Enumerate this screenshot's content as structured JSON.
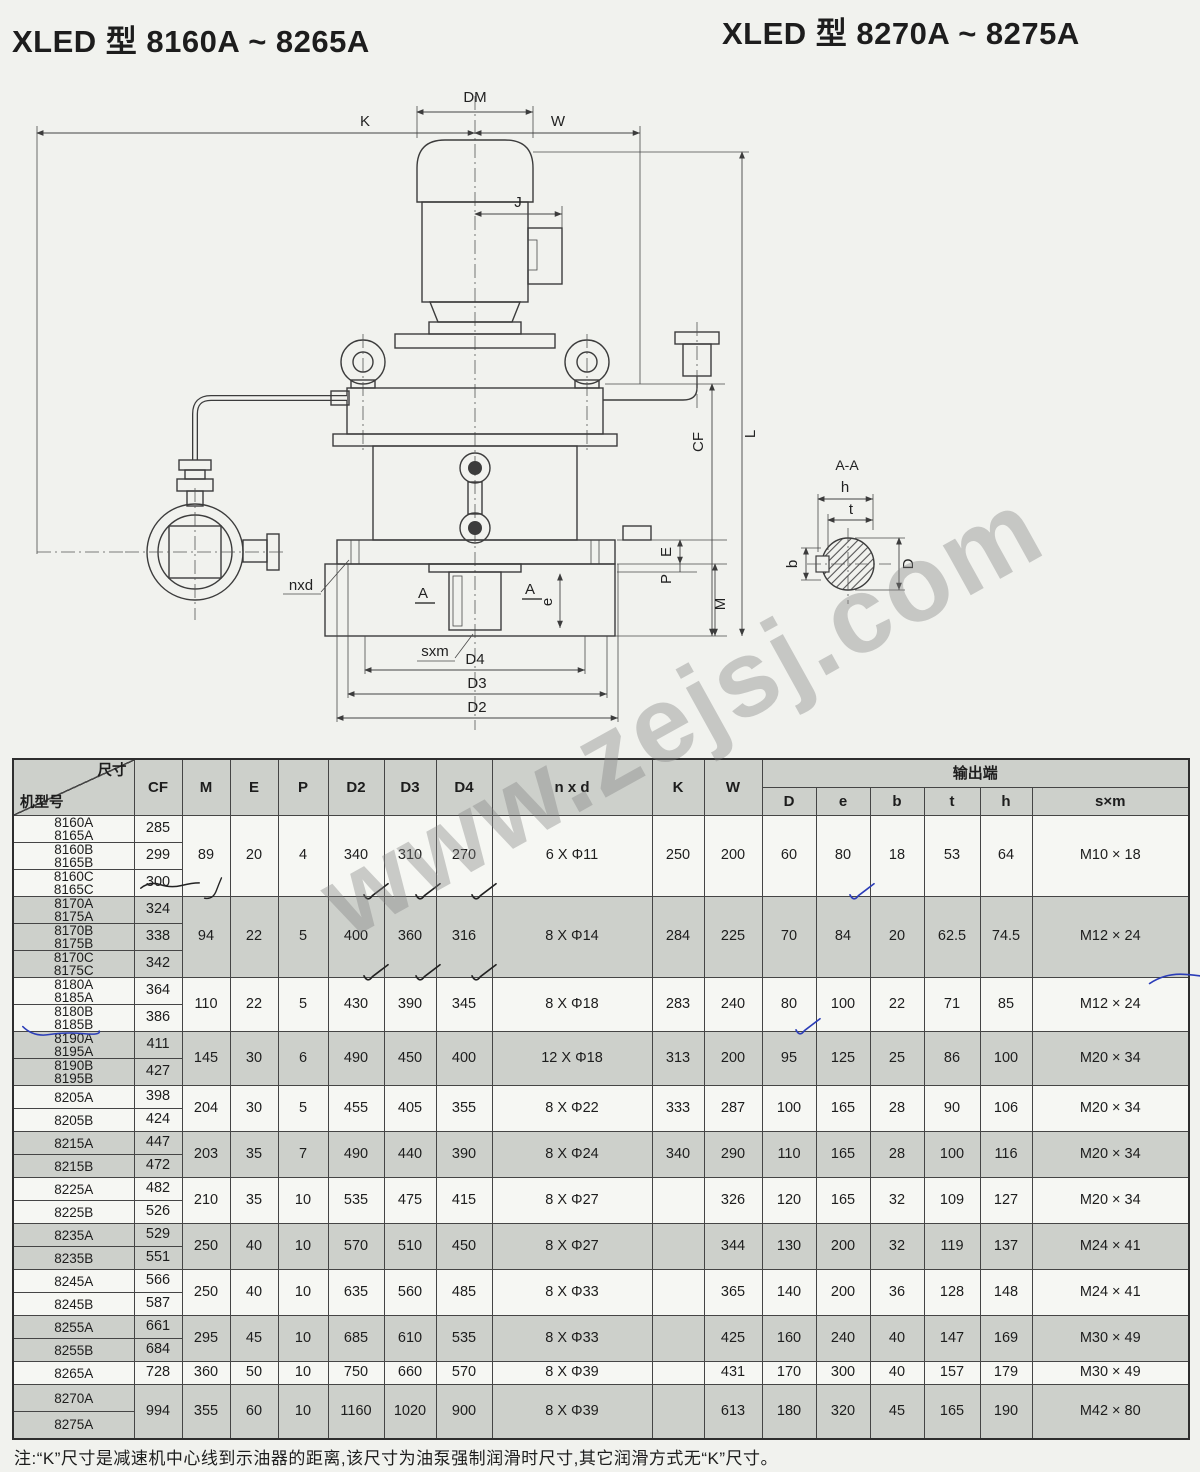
{
  "page": {
    "title_left": "XLED 型 8160A ~ 8265A",
    "title_right": "XLED 型 8270A ~ 8275A",
    "watermark": "www.zejsj.com",
    "note": "注:“K”尺寸是减速机中心线到示油器的距离,该尺寸为油泵强制润滑时尺寸,其它润滑方式无“K”尺寸。"
  },
  "drawing": {
    "labels": {
      "dm": "DM",
      "k": "K",
      "w": "W",
      "j": "J",
      "l": "L",
      "cf": "CF",
      "e": "E",
      "p": "P",
      "m": "M",
      "e2": "e",
      "nxd": "nxd",
      "sxm": "sxm",
      "a1": "A",
      "a2": "A",
      "d4": "D4",
      "d3": "D3",
      "d2": "D2",
      "sec": "A-A",
      "h": "h",
      "t": "t",
      "b": "b",
      "dd": "D"
    }
  },
  "table": {
    "corner": {
      "top": "尺寸",
      "bottom": "机型号"
    },
    "columns": [
      "CF",
      "M",
      "E",
      "P",
      "D2",
      "D3",
      "D4",
      "n x d",
      "K",
      "W"
    ],
    "output_group": {
      "label": "输出端",
      "columns": [
        "D",
        "e",
        "b",
        "t",
        "h",
        "s×m"
      ]
    },
    "groups": [
      {
        "shade": "light",
        "rows": [
          {
            "models": [
              "8160A",
              "8165A"
            ],
            "cf": "285"
          },
          {
            "models": [
              "8160B",
              "8165B"
            ],
            "cf": "299"
          },
          {
            "models": [
              "8160C",
              "8165C"
            ],
            "cf": "300"
          }
        ],
        "values": {
          "M": "89",
          "E": "20",
          "P": "4",
          "D2": "340",
          "D3": "310",
          "D4": "270",
          "nxd": "6 X Φ11",
          "K": "250",
          "W": "200",
          "D": "60",
          "e": "80",
          "b": "18",
          "t": "53",
          "h": "64",
          "sxm": "M10 × 18"
        },
        "marks": {
          "D2": "vd",
          "D3": "vd",
          "D4": "vd",
          "e": "vb",
          "M": "cd"
        },
        "row_marks": [
          {
            "row": 2,
            "col": "cf",
            "type": "st"
          }
        ]
      },
      {
        "shade": "gray",
        "rows": [
          {
            "models": [
              "8170A",
              "8175A"
            ],
            "cf": "324"
          },
          {
            "models": [
              "8170B",
              "8175B"
            ],
            "cf": "338"
          },
          {
            "models": [
              "8170C",
              "8175C"
            ],
            "cf": "342"
          }
        ],
        "values": {
          "M": "94",
          "E": "22",
          "P": "5",
          "D2": "400",
          "D3": "360",
          "D4": "316",
          "nxd": "8 X Φ14",
          "K": "284",
          "W": "225",
          "D": "70",
          "e": "84",
          "b": "20",
          "t": "62.5",
          "h": "74.5",
          "sxm": "M12 × 24"
        },
        "marks": {
          "D2": "vd",
          "D3": "vd",
          "D4": "vd",
          "sxm": "db"
        },
        "row_marks": []
      },
      {
        "shade": "light",
        "rows": [
          {
            "models": [
              "8180A",
              "8185A"
            ],
            "cf": "364"
          },
          {
            "models": [
              "8180B",
              "8185B"
            ],
            "cf": "386"
          }
        ],
        "values": {
          "M": "110",
          "E": "22",
          "P": "5",
          "D2": "430",
          "D3": "390",
          "D4": "345",
          "nxd": "8 X Φ18",
          "K": "283",
          "W": "240",
          "D": "80",
          "e": "100",
          "b": "22",
          "t": "71",
          "h": "85",
          "sxm": "M12 × 24"
        },
        "marks": {
          "D": "vb"
        },
        "row_marks": [
          {
            "row": 1,
            "col": "model",
            "type": "ub"
          }
        ]
      },
      {
        "shade": "gray",
        "rows": [
          {
            "models": [
              "8190A",
              "8195A"
            ],
            "cf": "411"
          },
          {
            "models": [
              "8190B",
              "8195B"
            ],
            "cf": "427"
          }
        ],
        "values": {
          "M": "145",
          "E": "30",
          "P": "6",
          "D2": "490",
          "D3": "450",
          "D4": "400",
          "nxd": "12 X Φ18",
          "K": "313",
          "W": "200",
          "D": "95",
          "e": "125",
          "b": "25",
          "t": "86",
          "h": "100",
          "sxm": "M20 × 34"
        },
        "marks": {},
        "row_marks": []
      },
      {
        "shade": "light",
        "rows": [
          {
            "models": [
              "8205A"
            ],
            "cf": "398"
          },
          {
            "models": [
              "8205B"
            ],
            "cf": "424"
          }
        ],
        "values": {
          "M": "204",
          "E": "30",
          "P": "5",
          "D2": "455",
          "D3": "405",
          "D4": "355",
          "nxd": "8 X Φ22",
          "K": "333",
          "W": "287",
          "D": "100",
          "e": "165",
          "b": "28",
          "t": "90",
          "h": "106",
          "sxm": "M20 × 34"
        },
        "marks": {},
        "row_marks": []
      },
      {
        "shade": "gray",
        "rows": [
          {
            "models": [
              "8215A"
            ],
            "cf": "447"
          },
          {
            "models": [
              "8215B"
            ],
            "cf": "472"
          }
        ],
        "values": {
          "M": "203",
          "E": "35",
          "P": "7",
          "D2": "490",
          "D3": "440",
          "D4": "390",
          "nxd": "8 X Φ24",
          "K": "340",
          "W": "290",
          "D": "110",
          "e": "165",
          "b": "28",
          "t": "100",
          "h": "116",
          "sxm": "M20 × 34"
        },
        "marks": {},
        "row_marks": []
      },
      {
        "shade": "light",
        "rows": [
          {
            "models": [
              "8225A"
            ],
            "cf": "482"
          },
          {
            "models": [
              "8225B"
            ],
            "cf": "526"
          }
        ],
        "values": {
          "M": "210",
          "E": "35",
          "P": "10",
          "D2": "535",
          "D3": "475",
          "D4": "415",
          "nxd": "8 X Φ27",
          "K": "",
          "W": "326",
          "D": "120",
          "e": "165",
          "b": "32",
          "t": "109",
          "h": "127",
          "sxm": "M20 × 34"
        },
        "marks": {},
        "row_marks": []
      },
      {
        "shade": "gray",
        "rows": [
          {
            "models": [
              "8235A"
            ],
            "cf": "529"
          },
          {
            "models": [
              "8235B"
            ],
            "cf": "551"
          }
        ],
        "values": {
          "M": "250",
          "E": "40",
          "P": "10",
          "D2": "570",
          "D3": "510",
          "D4": "450",
          "nxd": "8 X Φ27",
          "K": "",
          "W": "344",
          "D": "130",
          "e": "200",
          "b": "32",
          "t": "119",
          "h": "137",
          "sxm": "M24 × 41"
        },
        "marks": {},
        "row_marks": []
      },
      {
        "shade": "light",
        "rows": [
          {
            "models": [
              "8245A"
            ],
            "cf": "566"
          },
          {
            "models": [
              "8245B"
            ],
            "cf": "587"
          }
        ],
        "values": {
          "M": "250",
          "E": "40",
          "P": "10",
          "D2": "635",
          "D3": "560",
          "D4": "485",
          "nxd": "8 X Φ33",
          "K": "",
          "W": "365",
          "D": "140",
          "e": "200",
          "b": "36",
          "t": "128",
          "h": "148",
          "sxm": "M24 × 41"
        },
        "marks": {},
        "row_marks": []
      },
      {
        "shade": "gray",
        "rows": [
          {
            "models": [
              "8255A"
            ],
            "cf": "661"
          },
          {
            "models": [
              "8255B"
            ],
            "cf": "684"
          }
        ],
        "values": {
          "M": "295",
          "E": "45",
          "P": "10",
          "D2": "685",
          "D3": "610",
          "D4": "535",
          "nxd": "8 X Φ33",
          "K": "",
          "W": "425",
          "D": "160",
          "e": "240",
          "b": "40",
          "t": "147",
          "h": "169",
          "sxm": "M30 × 49"
        },
        "marks": {},
        "row_marks": []
      },
      {
        "shade": "light",
        "rows": [
          {
            "models": [
              "8265A"
            ],
            "cf": "728"
          }
        ],
        "values": {
          "M": "360",
          "E": "50",
          "P": "10",
          "D2": "750",
          "D3": "660",
          "D4": "570",
          "nxd": "8 X Φ39",
          "K": "",
          "W": "431",
          "D": "170",
          "e": "300",
          "b": "40",
          "t": "157",
          "h": "179",
          "sxm": "M30 × 49"
        },
        "marks": {},
        "row_marks": []
      },
      {
        "shade": "gray",
        "rows": [
          {
            "models": [
              "8270A"
            ],
            "cf": "994",
            "cf_rowspan": 2
          },
          {
            "models": [
              "8275A"
            ]
          }
        ],
        "values": {
          "M": "355",
          "E": "60",
          "P": "10",
          "D2": "1160",
          "D3": "1020",
          "D4": "900",
          "nxd": "8 X Φ39",
          "K": "",
          "W": "613",
          "D": "180",
          "e": "320",
          "b": "45",
          "t": "165",
          "h": "190",
          "sxm": "M42 × 80"
        },
        "marks": {},
        "row_marks": []
      }
    ]
  }
}
